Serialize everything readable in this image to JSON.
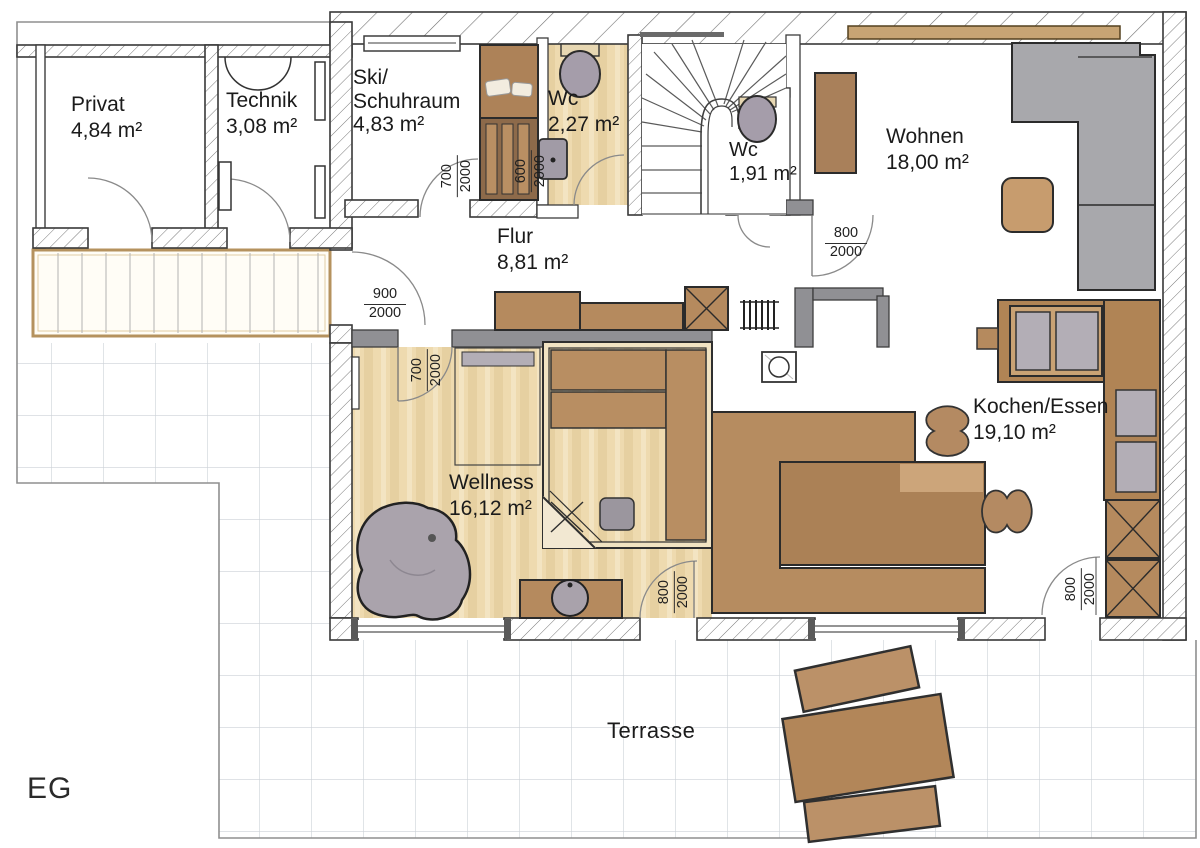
{
  "floor_plan": {
    "floor_label": "EG",
    "rooms": [
      {
        "name": "Privat",
        "area": "4,84 m²"
      },
      {
        "name": "Technik",
        "area": "3,08 m²"
      },
      {
        "name": "Ski/",
        "name2": "Schuhraum",
        "area": "4,83 m²"
      },
      {
        "name": "Wc",
        "area": "2,27 m²"
      },
      {
        "name": "Wc",
        "area": "1,91 m²"
      },
      {
        "name": "Wohnen",
        "area": "18,00 m²"
      },
      {
        "name": "Flur",
        "area": "8,81 m²"
      },
      {
        "name": "Wellness",
        "area": "16,12 m²"
      },
      {
        "name": "Kochen/Essen",
        "area": "19,10 m²"
      }
    ],
    "outdoor_labels": {
      "terrace": "Terrasse"
    },
    "door_dimensions": [
      {
        "width": "900",
        "height": "2000"
      },
      {
        "width": "700",
        "height": "2000"
      },
      {
        "width": "600",
        "height": "2000"
      },
      {
        "width": "800",
        "height": "2000"
      },
      {
        "width": "700",
        "height": "2000"
      },
      {
        "width": "800",
        "height": "2000"
      },
      {
        "width": "800",
        "height": "2000"
      }
    ],
    "colors": {
      "wood_floor": "#eedaaf",
      "furniture_brown": "#b58a5e",
      "upholstery_gray": "#a8a8ac",
      "window_sill": "#c7a474"
    }
  }
}
